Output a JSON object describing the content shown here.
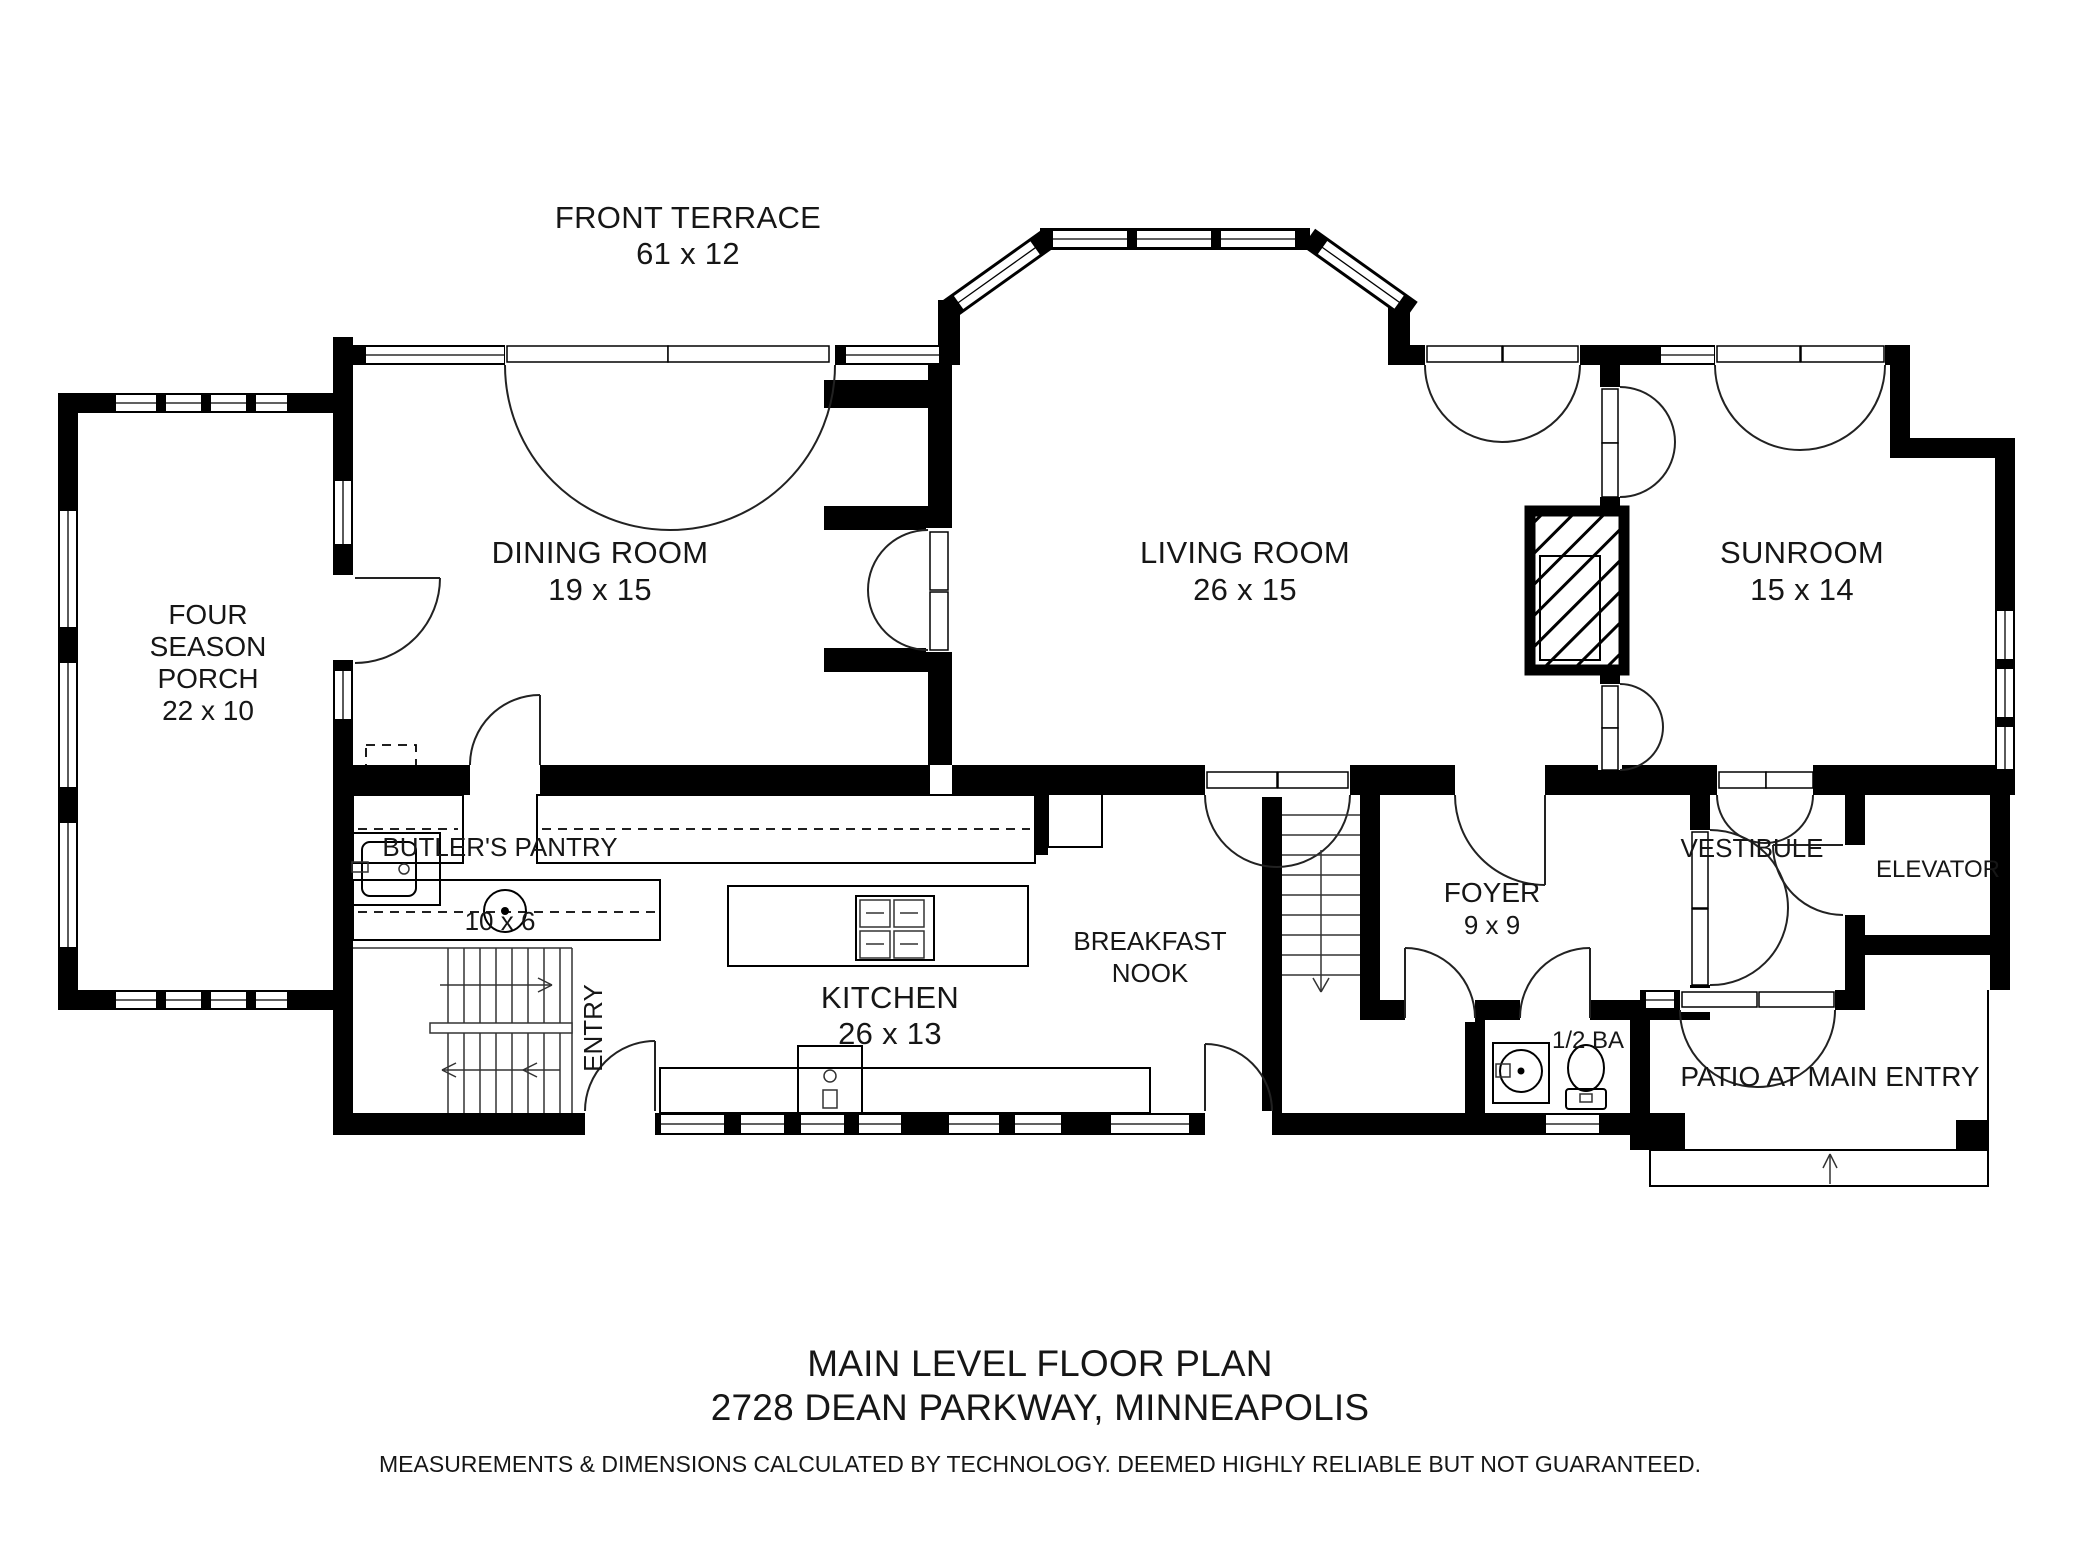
{
  "floor_plan": {
    "rooms": {
      "front_terrace": {
        "name": "FRONT TERRACE",
        "dims": "61 x 12"
      },
      "four_season_porch": {
        "name_line1": "FOUR",
        "name_line2": "SEASON",
        "name_line3": "PORCH",
        "dims": "22 x 10"
      },
      "dining_room": {
        "name": "DINING ROOM",
        "dims": "19 x 15"
      },
      "living_room": {
        "name": "LIVING ROOM",
        "dims": "26 x 15"
      },
      "sunroom": {
        "name": "SUNROOM",
        "dims": "15 x 14"
      },
      "butlers_pantry": {
        "name": "BUTLER'S PANTRY",
        "dims": "10 x 6"
      },
      "kitchen": {
        "name": "KITCHEN",
        "dims": "26 x 13"
      },
      "breakfast_nook": {
        "name_line1": "BREAKFAST",
        "name_line2": "NOOK"
      },
      "entry": {
        "name": "ENTRY"
      },
      "foyer": {
        "name": "FOYER",
        "dims": "9 x 9"
      },
      "vestibule": {
        "name": "VESTIBULE"
      },
      "elevator": {
        "name": "ELEVATOR"
      },
      "half_bath": {
        "name": "1/2 BA"
      },
      "patio": {
        "name": "PATIO AT MAIN ENTRY"
      }
    },
    "title_block": {
      "title": "MAIN LEVEL FLOOR PLAN",
      "address": "2728 DEAN PARKWAY, MINNEAPOLIS",
      "disclaimer": "MEASUREMENTS & DIMENSIONS CALCULATED BY TECHNOLOGY. DEEMED HIGHLY RELIABLE BUT NOT GUARANTEED."
    },
    "colors": {
      "walls": "#000000",
      "background": "#ffffff"
    }
  }
}
